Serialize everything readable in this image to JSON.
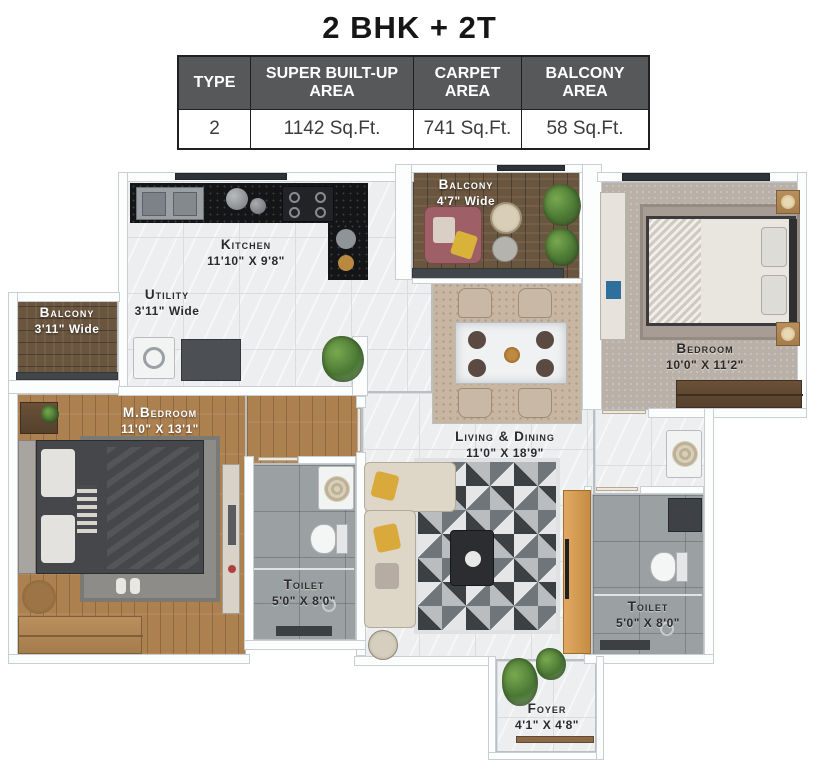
{
  "title": "2 BHK + 2T",
  "table": {
    "headers": [
      "TYPE",
      "SUPER BUILT-UP AREA",
      "CARPET AREA",
      "BALCONY AREA"
    ],
    "row": [
      "2",
      "1142 Sq.Ft.",
      "741 Sq.Ft.",
      "58 Sq.Ft."
    ]
  },
  "rooms": {
    "kitchen": {
      "name": "Kitchen",
      "dims": "11'10\" X 9'8\""
    },
    "utility": {
      "name": "Utility",
      "dims": "3'11\" Wide"
    },
    "balcony_top": {
      "name": "Balcony",
      "dims": "4'7\" Wide"
    },
    "balcony_left": {
      "name": "Balcony",
      "dims": "3'11\" Wide"
    },
    "bedroom": {
      "name": "Bedroom",
      "dims": "10'0\" X 11'2\""
    },
    "master_bedroom": {
      "name": "M.Bedroom",
      "dims": "11'0\" X 13'1\""
    },
    "living_dining": {
      "name": "Living & Dining",
      "dims": "11'0\" X 18'9\""
    },
    "toilet_left": {
      "name": "Toilet",
      "dims": "5'0\" X 8'0\""
    },
    "toilet_right": {
      "name": "Toilet",
      "dims": "5'0\" X 8'0\""
    },
    "foyer": {
      "name": "Foyer",
      "dims": "4'1\" X 4'8\""
    }
  },
  "colors": {
    "table_header_bg": "#57585a",
    "counter_black": "#141517",
    "wood_master": "#ad8050",
    "balcony_wood": "#6a553f",
    "tile_grey": "#9ba1a2",
    "tv_unit_orange": "#d59a55",
    "railing_dark": "#41464b"
  }
}
